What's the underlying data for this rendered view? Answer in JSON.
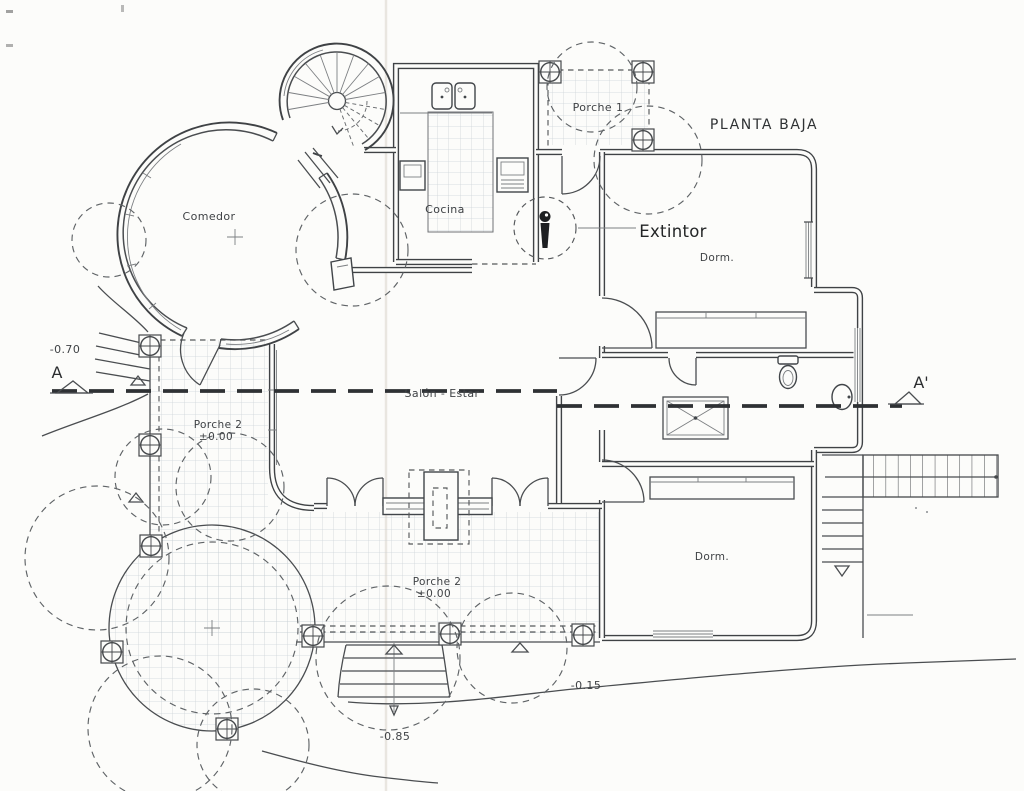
{
  "title": "PLANTA BAJA",
  "extinguisher": {
    "label": "Extintor"
  },
  "rooms": {
    "comedor": {
      "label": "Comedor"
    },
    "cocina": {
      "label": "Cocina"
    },
    "porche1": {
      "label": "Porche 1"
    },
    "salon_estar": {
      "label": "Salón - Estar"
    },
    "dorm_norte": {
      "label": "Dorm."
    },
    "dorm_sur": {
      "label": "Dorm."
    },
    "porche2_oeste": {
      "label": "Porche 2",
      "level": "±0.00"
    },
    "porche2_sur": {
      "label": "Porche 2",
      "level": "±0.00"
    }
  },
  "levels": {
    "acceso_norte": "-0.70",
    "jardin_este": "-0.15",
    "escalera_sur": "-0.85"
  },
  "section": {
    "start": "A",
    "end": "A'"
  },
  "colors": {
    "ink": "#3f4245",
    "paper": "#fcfcfa",
    "tile": "#c4cdd3",
    "section": "#2e3134"
  },
  "icons": {
    "extinguisher": "extinguisher-icon",
    "spiral_stair": "spiral-staircase-icon",
    "toilet": "toilet-icon",
    "shower": "shower-tray-icon",
    "washbasin": "washbasin-icon",
    "kitchen_sink": "double-sink-icon",
    "column": "column-icon",
    "tree": "tree-canopy-icon",
    "stairs": "stairs-icon",
    "section_arrow": "section-arrow-icon"
  }
}
